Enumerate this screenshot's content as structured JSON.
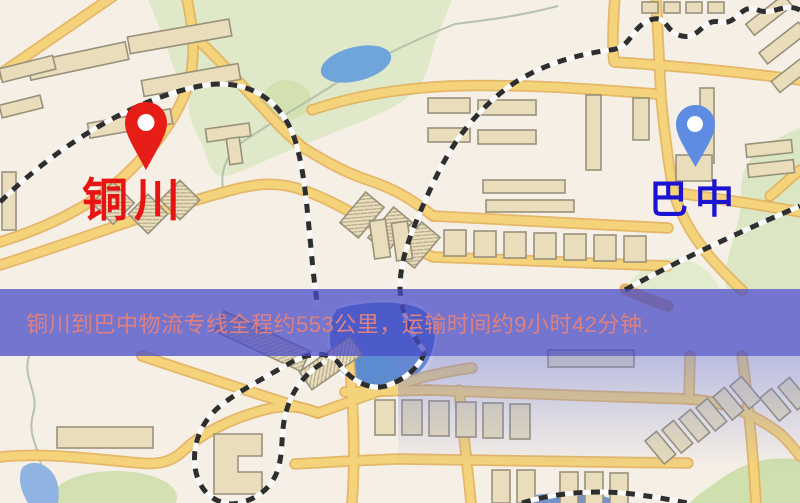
{
  "window": {
    "width": 800,
    "height": 503
  },
  "map": {
    "type": "stylized-city-map",
    "markers": [
      {
        "id": "origin",
        "label": "铜川",
        "pin_color": "#e71d18",
        "label_color": "#e81414"
      },
      {
        "id": "destination",
        "label": "巴中",
        "pin_color": "#5e8ce2",
        "label_color": "#1a14d2"
      }
    ],
    "info_banner": {
      "text": "铜川到巴中物流专线全程约553公里，运输时间约9小时42分钟.",
      "origin": "铜川",
      "destination": "巴中",
      "distance_text": "约553公里",
      "duration_text": "约9小时42分钟",
      "background_color": "rgba(70,74,198,0.74)",
      "text_color": "#df8080"
    },
    "palette": {
      "land": "#f6efe5",
      "road_fill": "#f4d37b",
      "road_casing": "#e2ad55",
      "building_fill": "#e9ddbb",
      "building_outline": "#98917b",
      "green_area": "#dfe9c9",
      "park_dark": "#d2e0ae",
      "pond_blue": "#6fa5da",
      "lake_blue": "#5d8bd0",
      "water_small": "#8fb4e2",
      "railway": "#2e2e2e"
    }
  }
}
